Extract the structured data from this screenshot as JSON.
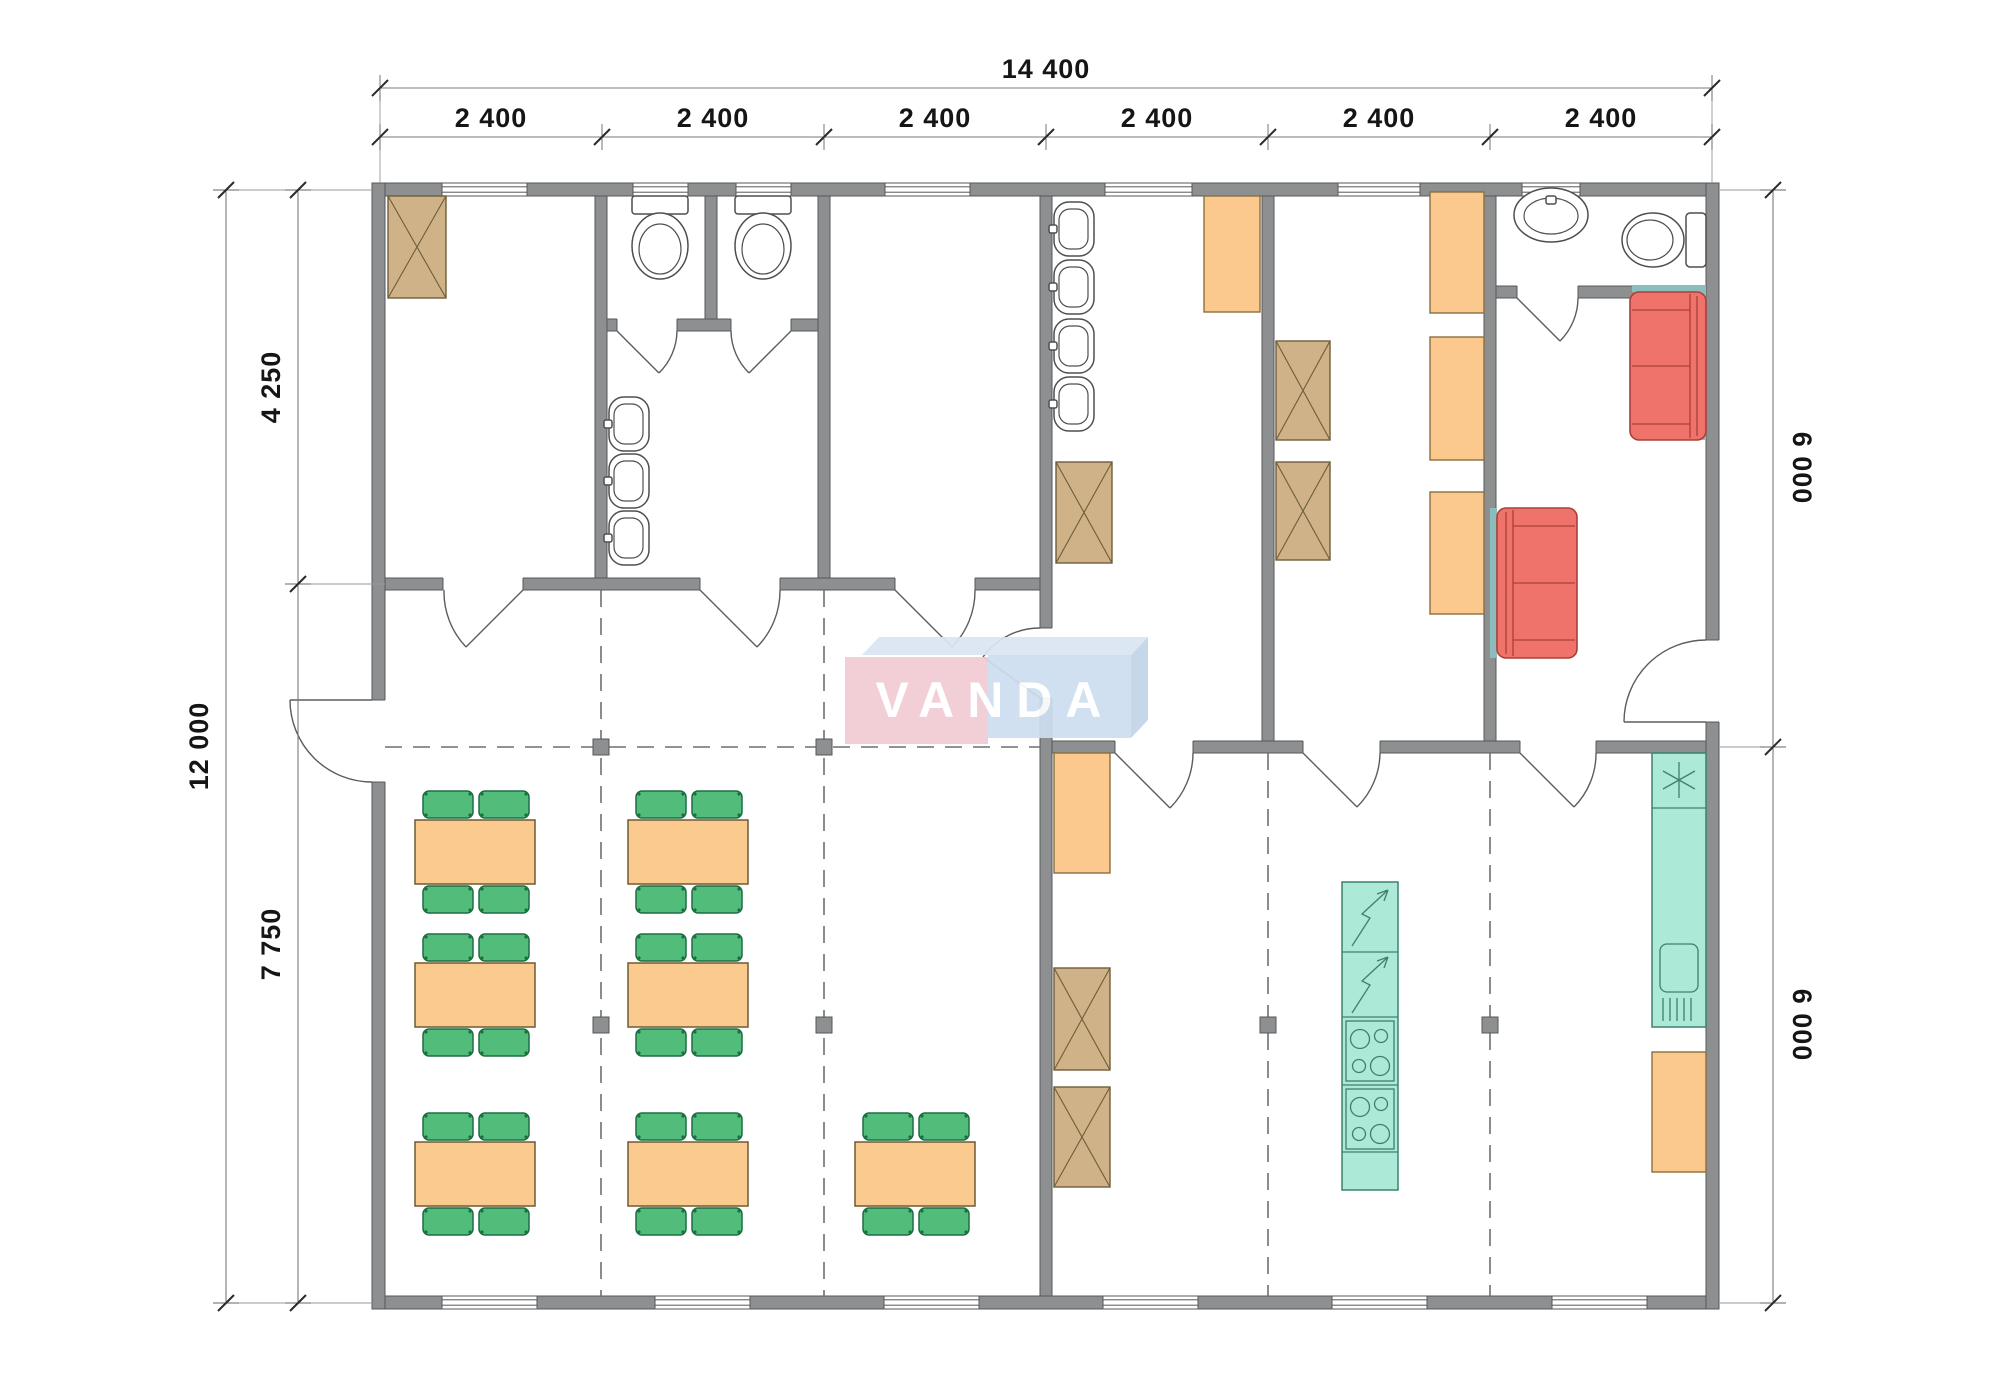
{
  "logo": {
    "text": "VANDA",
    "pink": "#f2cbd4",
    "blue": "#cddeef"
  },
  "dimensions": {
    "total_width": "14 400",
    "modules": [
      "2 400",
      "2 400",
      "2 400",
      "2 400",
      "2 400",
      "2 400"
    ],
    "total_depth": "12 000",
    "left_upper": "4 250",
    "left_lower": "7 750",
    "right_upper": "6 000",
    "right_lower": "6 000"
  },
  "colors": {
    "wall": "#8d8f91",
    "wardrobe_tan": "#cfb287",
    "locker_orange": "#fbc98d",
    "table_orange": "#fbca8e",
    "chair_green": "#52bd7a",
    "kitchen_teal": "#ade9d7",
    "sofa_red": "#f0736b",
    "grid_marker": "#8d8f91"
  },
  "icons": {
    "wardrobe": "crossed-box",
    "locker": "plain-box",
    "dining_set": "table-with-4-chairs",
    "toilet": "tank-and-bowl",
    "sink": "wall-basin",
    "sofa": "two-seat-sofa",
    "stove": "4-burner-cooktop",
    "water_heater": "lightning-bolt-unit",
    "fridge": "asterisk-unit",
    "counter_sink": "basin-with-drainboard"
  }
}
